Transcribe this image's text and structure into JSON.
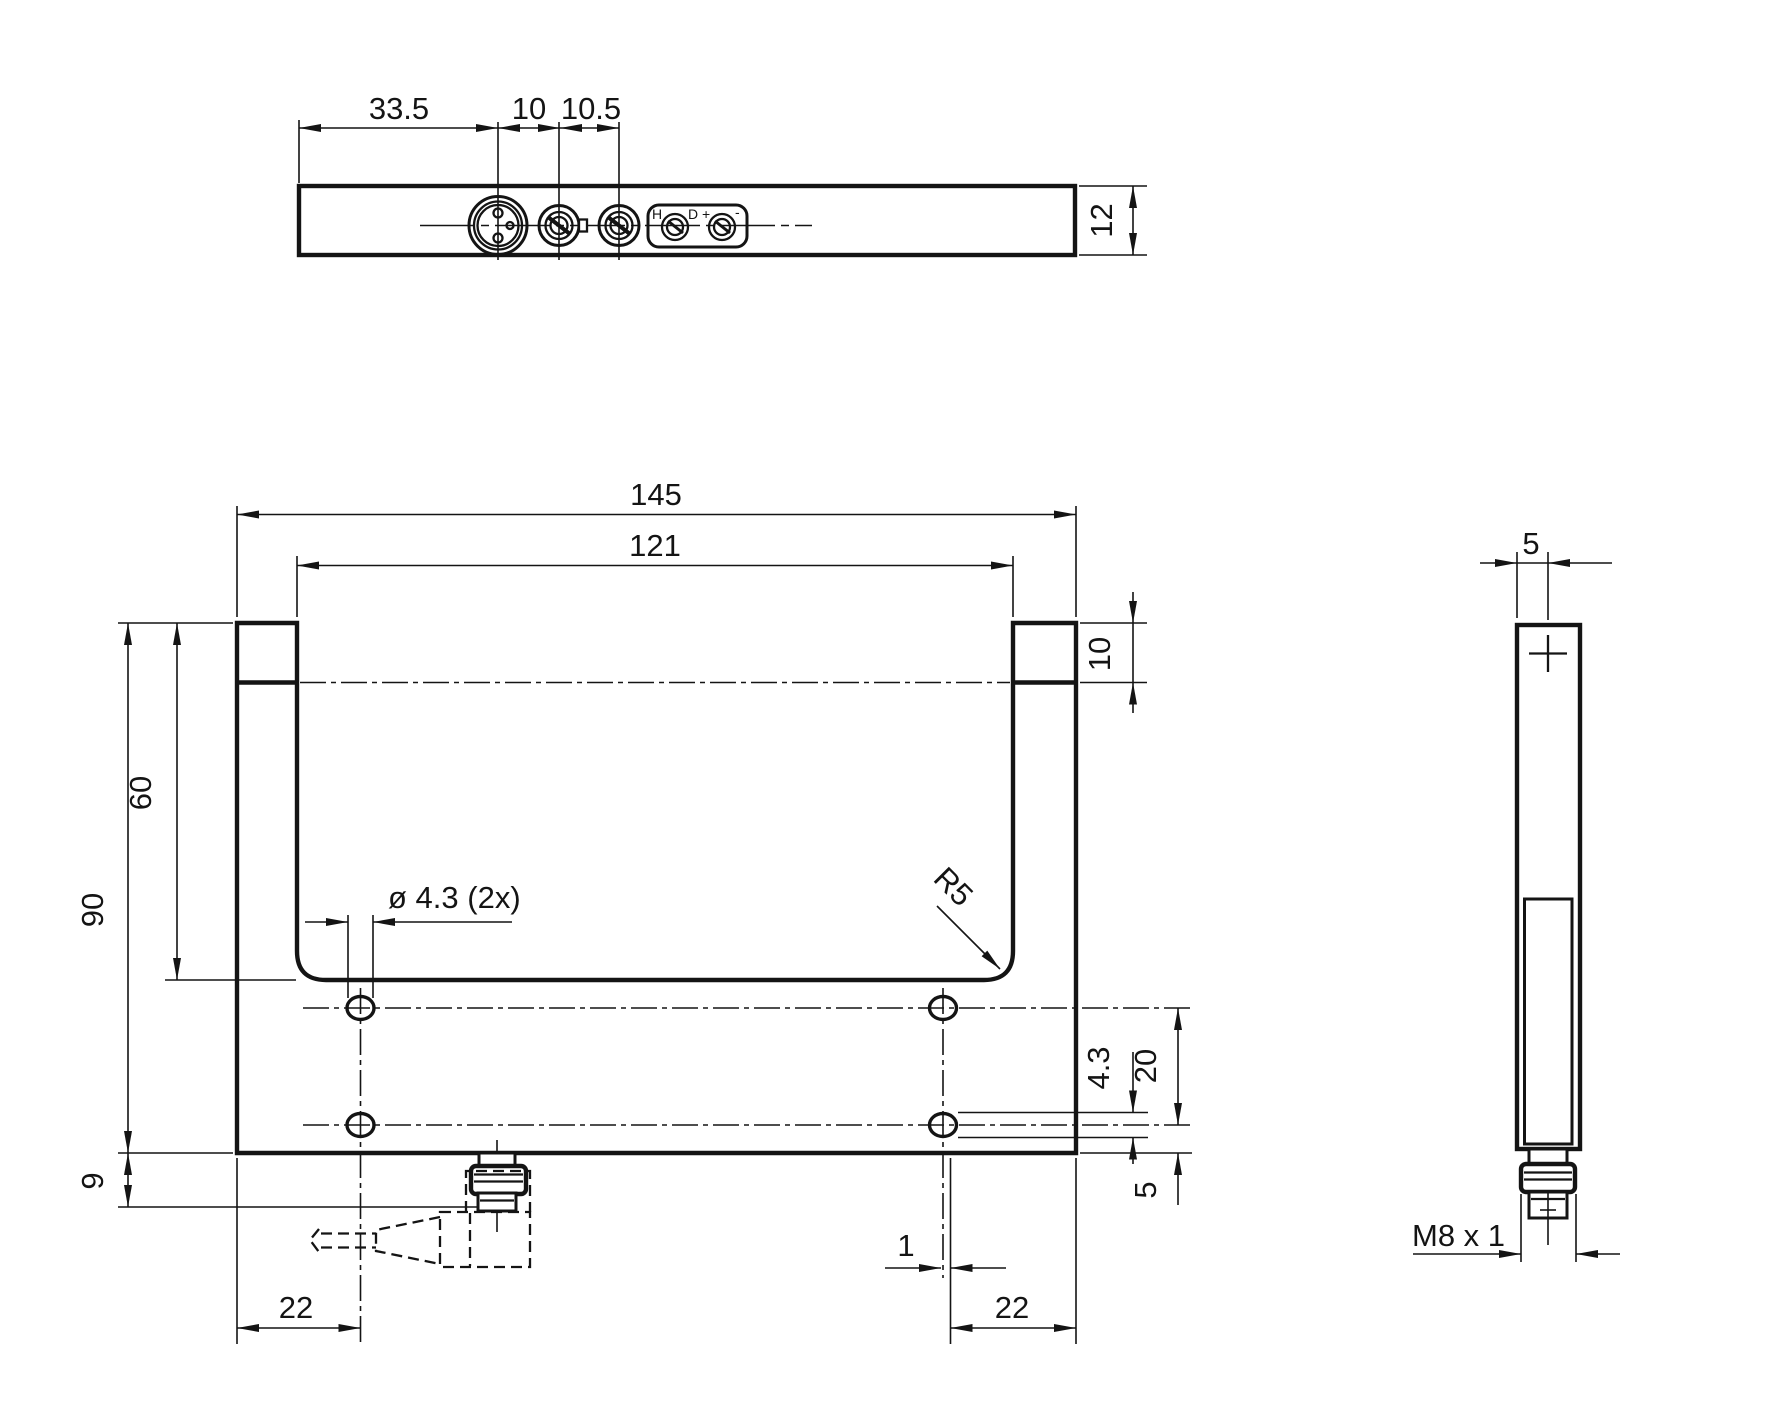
{
  "views": {
    "top": {
      "dim_33_5": "33.5",
      "dim_10": "10",
      "dim_10_5": "10.5",
      "dim_12": "12",
      "label_h": "H",
      "label_d_plus": "D +",
      "label_minus": "-"
    },
    "front": {
      "dim_145": "145",
      "dim_121": "121",
      "dim_10": "10",
      "dim_90": "90",
      "dim_60": "60",
      "dim_9": "9",
      "hole_callout": "ø 4.3 (2x)",
      "radius_callout": "R5",
      "dim_4_3": "4.3",
      "dim_20": "20",
      "dim_5": "5",
      "dim_1": "1",
      "dim_22_left": "22",
      "dim_22_right": "22"
    },
    "side": {
      "dim_5": "5",
      "thread_callout": "M8 x 1"
    }
  }
}
